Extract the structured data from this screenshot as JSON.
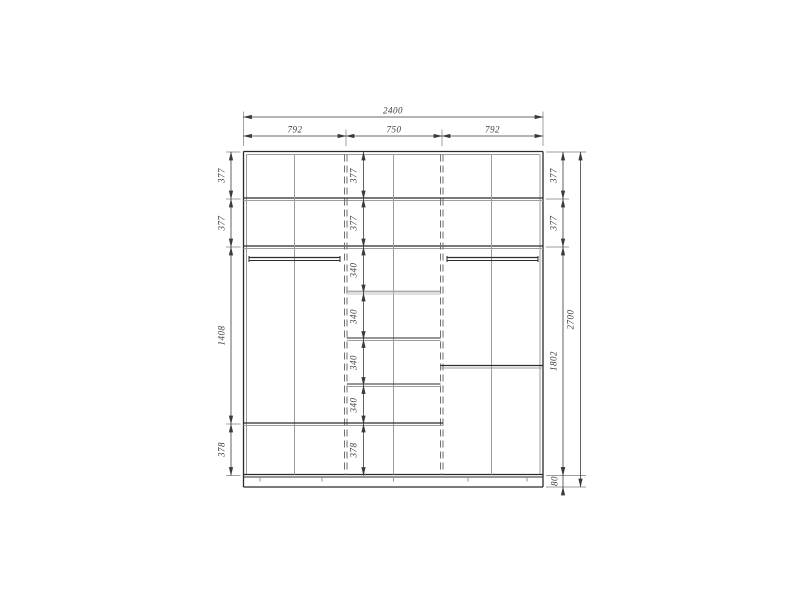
{
  "diagram": {
    "type": "furniture-dimension-drawing",
    "subject": "three-section wardrobe interior elevation",
    "units": "mm",
    "top_dims": {
      "total": "2400",
      "sections": [
        "792",
        "750",
        "792"
      ]
    },
    "left_dims": [
      "377",
      "377",
      "1408",
      "378"
    ],
    "middle_dims": [
      "377",
      "377",
      "340",
      "340",
      "340",
      "340",
      "378"
    ],
    "right_dims": [
      "377",
      "377",
      "1802",
      "80"
    ],
    "height_total": "2700",
    "colors": {
      "structure_line": "#2b2b2b",
      "secondary_line": "#9c9c9c",
      "dimension_line": "#3a3a3a",
      "background": "#ffffff"
    }
  }
}
